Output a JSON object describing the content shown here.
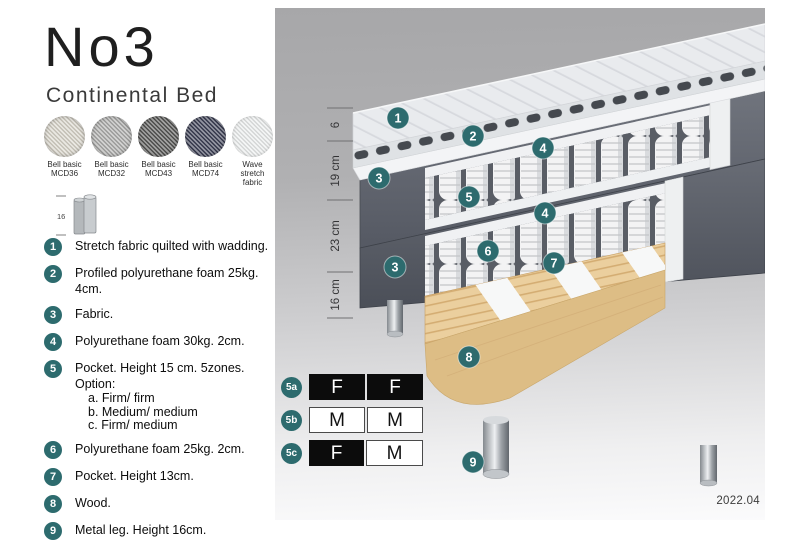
{
  "header": {
    "title": "No3",
    "subtitle": "Continental Bed"
  },
  "swatches": [
    {
      "name": "Bell basic",
      "code": "MCD36",
      "color": "#d9d5ca"
    },
    {
      "name": "Bell basic",
      "code": "MCD32",
      "color": "#adadab"
    },
    {
      "name": "Bell basic",
      "code": "MCD43",
      "color": "#565654"
    },
    {
      "name": "Bell basic",
      "code": "MCD74",
      "color": "#3b3e54"
    },
    {
      "name": "Wave",
      "code": "stretch fabric",
      "color": "#eceeee"
    }
  ],
  "leg_icon": {
    "height_label": "16"
  },
  "items": [
    {
      "num": "1",
      "text": "Stretch fabric quilted with wadding."
    },
    {
      "num": "2",
      "text": "Profiled polyurethane foam 25kg. 4cm."
    },
    {
      "num": "3",
      "text": "Fabric."
    },
    {
      "num": "4",
      "text": "Polyurethane foam 30kg. 2cm."
    },
    {
      "num": "5",
      "text": "Pocket. Height 15 cm. 5zones. Option:",
      "options": [
        "a. Firm/ firm",
        "b. Medium/ medium",
        "c. Firm/ medium"
      ]
    },
    {
      "num": "6",
      "text": "Polyurethane foam 25kg. 2cm."
    },
    {
      "num": "7",
      "text": "Pocket. Height 13cm."
    },
    {
      "num": "8",
      "text": "Wood."
    },
    {
      "num": "9",
      "text": "Metal leg. Height 16cm."
    }
  ],
  "diagram": {
    "dimensions": [
      "6",
      "19 cm",
      "23 cm",
      "16 cm"
    ],
    "badges": [
      "1",
      "2",
      "3",
      "4",
      "5",
      "4",
      "3",
      "6",
      "7",
      "8",
      "9"
    ],
    "firmness": [
      {
        "label": "5a",
        "cells": [
          {
            "text": "F",
            "variant": "dark"
          },
          {
            "text": "F",
            "variant": "dark"
          }
        ]
      },
      {
        "label": "5b",
        "cells": [
          {
            "text": "M",
            "variant": "light"
          },
          {
            "text": "M",
            "variant": "light"
          }
        ]
      },
      {
        "label": "5c",
        "cells": [
          {
            "text": "F",
            "variant": "dark"
          },
          {
            "text": "M",
            "variant": "light"
          }
        ]
      }
    ],
    "version": "2022.04",
    "accent_color": "#2d6b6e"
  }
}
